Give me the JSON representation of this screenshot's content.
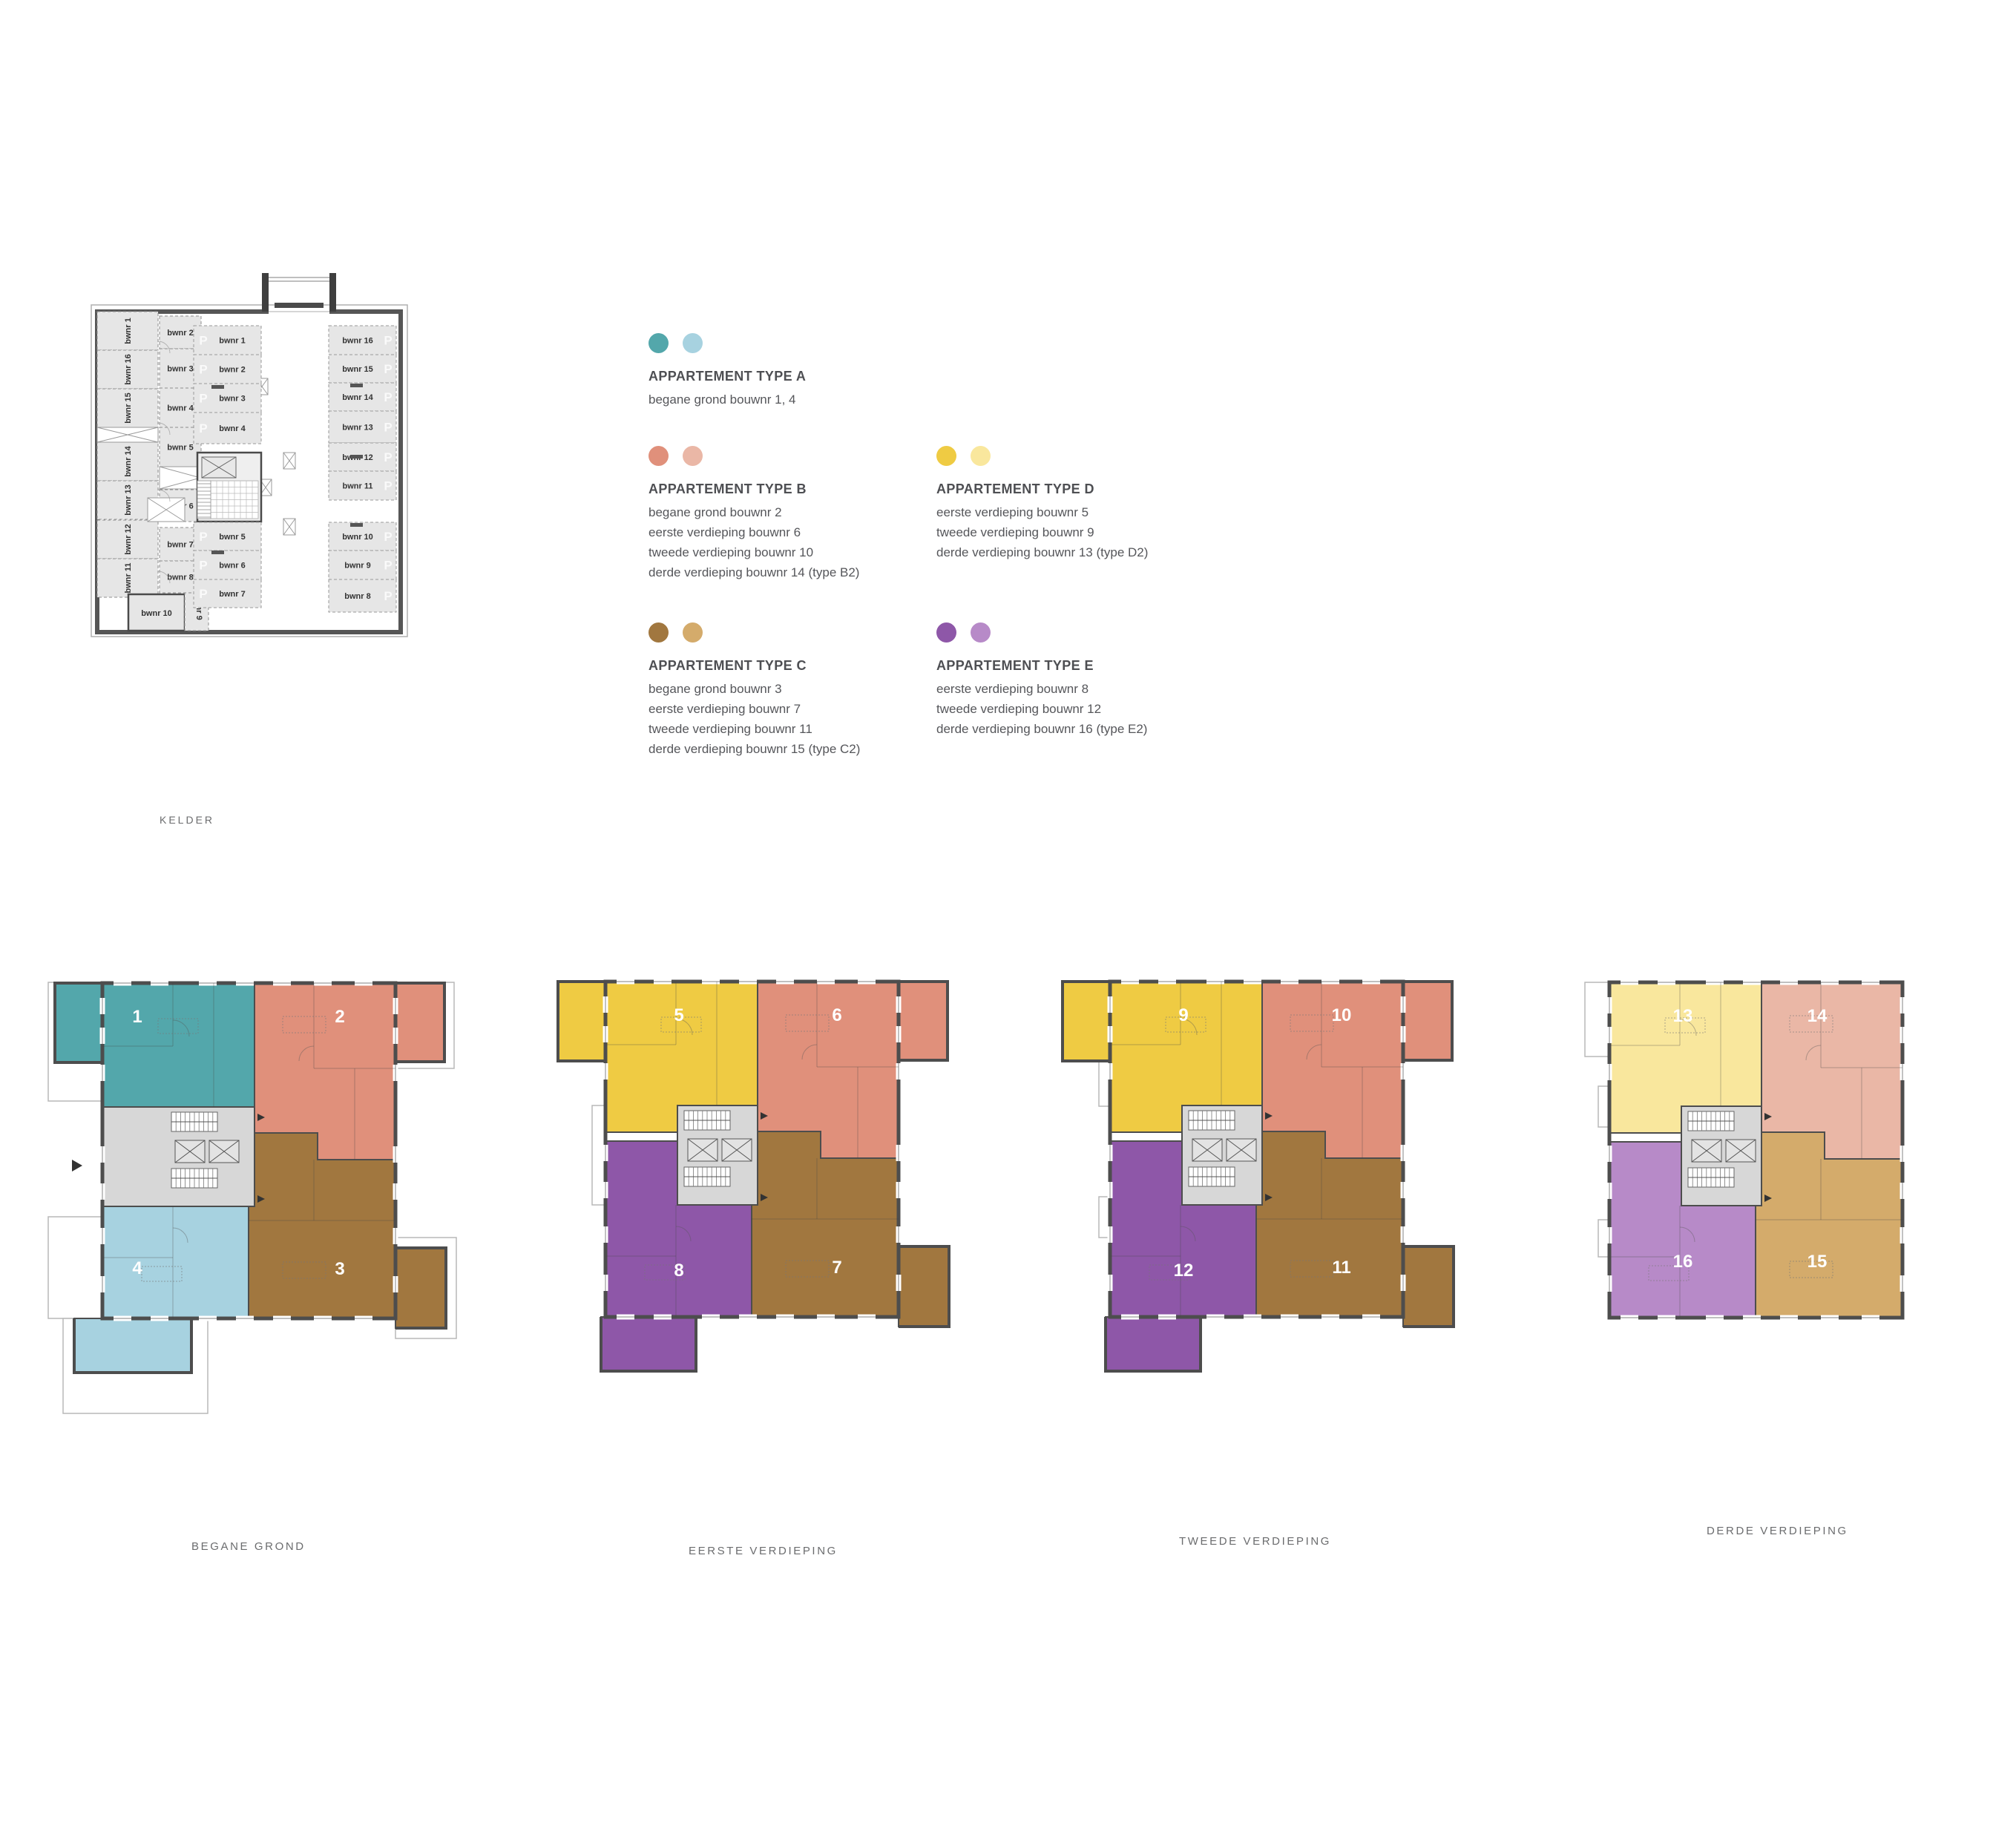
{
  "palette": {
    "teal": "#53a7ab",
    "light_teal": "#a7d2e0",
    "salmon": "#e0907b",
    "light_salmon": "#eab7a6",
    "yellow": "#efcb43",
    "light_yellow": "#f9e79d",
    "brown": "#a1773f",
    "light_brown": "#d4ab6b",
    "purple": "#8e57a8",
    "light_purple": "#b78ac8",
    "core_gray": "#d7d7d7",
    "wall": "#4d4d4d",
    "unit_gray": "#e6e6e6",
    "text": "#55565a",
    "label": "#6b6c6e"
  },
  "legend": [
    {
      "id": "A",
      "dots": [
        "#53a7ab",
        "#a7d2e0"
      ],
      "title": "APPARTEMENT TYPE A",
      "lines": [
        "begane grond bouwnr 1, 4"
      ]
    },
    {
      "id": "B",
      "dots": [
        "#e0907b",
        "#eab7a6"
      ],
      "title": "APPARTEMENT TYPE B",
      "lines": [
        "begane grond bouwnr 2",
        "eerste verdieping bouwnr 6",
        "tweede verdieping bouwnr 10",
        "derde verdieping bouwnr 14 (type B2)"
      ]
    },
    {
      "id": "D",
      "dots": [
        "#efcb43",
        "#f9e79d"
      ],
      "title": "APPARTEMENT TYPE D",
      "lines": [
        "eerste verdieping bouwnr 5",
        "tweede verdieping bouwnr 9",
        "derde verdieping bouwnr 13 (type D2)"
      ]
    },
    {
      "id": "C",
      "dots": [
        "#a1773f",
        "#d4ab6b"
      ],
      "title": "APPARTEMENT TYPE C",
      "lines": [
        "begane grond bouwnr 3",
        "eerste verdieping bouwnr 7",
        "tweede verdieping bouwnr 11",
        "derde verdieping bouwnr 15 (type C2)"
      ]
    },
    {
      "id": "E",
      "dots": [
        "#8e57a8",
        "#b78ac8"
      ],
      "title": "APPARTEMENT TYPE E",
      "lines": [
        "eerste verdieping bouwnr 8",
        "tweede verdieping bouwnr 12",
        "derde verdieping bouwnr 16 (type E2)"
      ]
    }
  ],
  "kelder": {
    "label": "KELDER",
    "p_letter": "P",
    "left_units": [
      "bwnr 1",
      "bwnr 16",
      "bwnr 15",
      "bwnr 14",
      "bwnr 13",
      "bwnr 12",
      "bwnr 11"
    ],
    "mid_units_top": [
      "bwnr 2",
      "bwnr 3",
      "bwnr 4",
      "bwnr 5"
    ],
    "mid_units_bottom": [
      "bwnr 6",
      "bwnr 7",
      "bwnr 8"
    ],
    "bottom_unit_h": "bwnr 10",
    "bottom_unit_v": "bwnr 9",
    "parking_left_top": [
      "bwnr 1",
      "bwnr 2",
      "bwnr 3",
      "bwnr 4"
    ],
    "parking_left_bottom": [
      "bwnr 5",
      "bwnr 6",
      "bwnr 7"
    ],
    "parking_right": [
      "bwnr 16",
      "bwnr 15",
      "bwnr 14",
      "bwnr 13",
      "bwnr 12",
      "bwnr 11",
      "bwnr 10",
      "bwnr 9",
      "bwnr 8"
    ]
  },
  "floors": [
    {
      "label": "BEGANE GROND",
      "variant": "ground",
      "units": [
        {
          "no": "1",
          "color": "teal",
          "pos": "tl"
        },
        {
          "no": "2",
          "color": "salmon",
          "pos": "tr"
        },
        {
          "no": "3",
          "color": "brown",
          "pos": "br"
        },
        {
          "no": "4",
          "color": "light_teal",
          "pos": "bl"
        }
      ]
    },
    {
      "label": "EERSTE VERDIEPING",
      "variant": "upper1",
      "units": [
        {
          "no": "5",
          "color": "yellow",
          "pos": "tl"
        },
        {
          "no": "6",
          "color": "salmon",
          "pos": "tr"
        },
        {
          "no": "7",
          "color": "brown",
          "pos": "br"
        },
        {
          "no": "8",
          "color": "purple",
          "pos": "bl"
        }
      ]
    },
    {
      "label": "TWEEDE VERDIEPING",
      "variant": "upper2",
      "units": [
        {
          "no": "9",
          "color": "yellow",
          "pos": "tl"
        },
        {
          "no": "10",
          "color": "salmon",
          "pos": "tr"
        },
        {
          "no": "11",
          "color": "brown",
          "pos": "br"
        },
        {
          "no": "12",
          "color": "purple",
          "pos": "bl"
        }
      ]
    },
    {
      "label": "DERDE VERDIEPING",
      "variant": "top",
      "units": [
        {
          "no": "13",
          "color": "light_yellow",
          "pos": "tl"
        },
        {
          "no": "14",
          "color": "light_salmon",
          "pos": "tr"
        },
        {
          "no": "15",
          "color": "light_brown",
          "pos": "br"
        },
        {
          "no": "16",
          "color": "light_purple",
          "pos": "bl"
        }
      ]
    }
  ]
}
